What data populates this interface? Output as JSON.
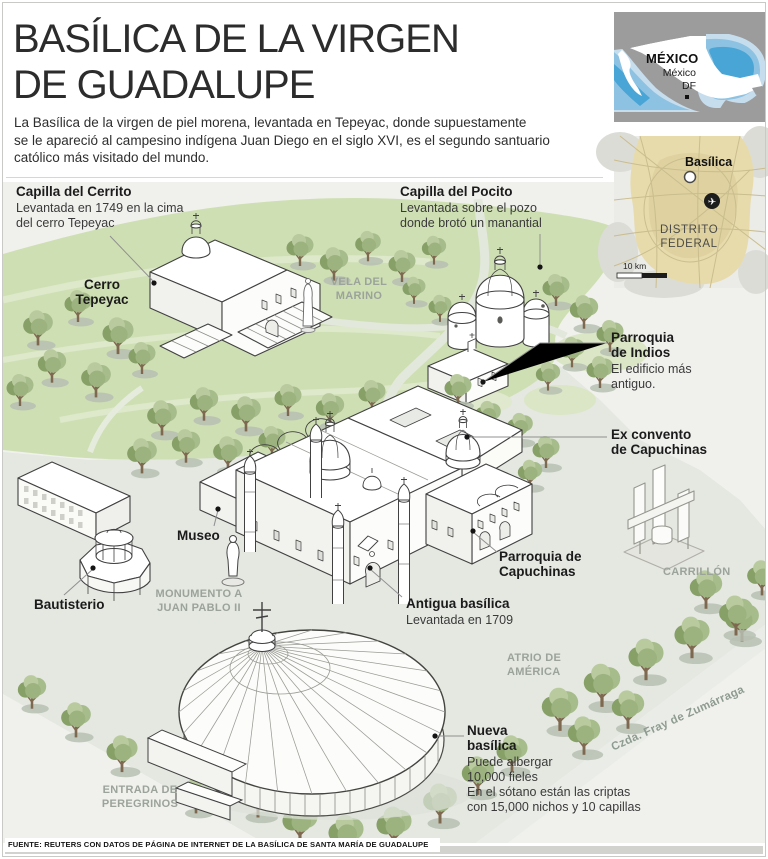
{
  "header": {
    "title": "BASÍLICA DE LA VIRGEN\nDE GUADALUPE",
    "intro": "La Basílica de la virgen de piel morena, levantada en Tepeyac, donde supuestamente\nse le apareció al campesino indígena Juan Diego en el siglo XVI, es el segundo santuario\ncatólico más visitado del mundo."
  },
  "maps": {
    "country": {
      "name": "MÉXICO",
      "city": "México\nDF"
    },
    "city": {
      "poi": "Basílica",
      "region": "DISTRITO\nFEDERAL",
      "scale": "10 km"
    }
  },
  "callouts": {
    "cerrito": {
      "title": "Capilla del Cerrito",
      "desc": "Levantada en 1749 en la cima\ndel cerro Tepeyac"
    },
    "pocito": {
      "title": "Capilla del Pocito",
      "desc": "Levantada sobre el pozo\ndonde brotó un manantial"
    },
    "indios": {
      "title": "Parroquia\nde Indios",
      "desc": "El edificio más\nantiguo."
    },
    "exconvento": {
      "title": "Ex convento\nde Capuchinas"
    },
    "museo": {
      "title": "Museo"
    },
    "bautisterio": {
      "title": "Bautisterio"
    },
    "capuchinas": {
      "title": "Parroquia de\nCapuchinas"
    },
    "antigua": {
      "title": "Antigua basílica",
      "desc": "Levantada en 1709"
    },
    "nueva": {
      "title": "Nueva\nbasílica",
      "desc": "Puede albergar\n10,000 fieles\nEn el sótano están las criptas\ncon 15,000 nichos y 10 capillas"
    }
  },
  "areas": {
    "cerro": "Cerro\nTepeyac",
    "vela": "VELA DEL\nMARINO",
    "monumento": "MONUMENTO A\nJUAN PABLO II",
    "carrillon": "CARRILLÓN",
    "atrio": "ATRIO DE\nAMÉRICA",
    "entrada": "ENTRADA DE\nPEREGRINOS",
    "calzada": "Czda. Fray de Zumárraga"
  },
  "footer": {
    "source": "FUENTE: REUTERS CON DATOS DE PÁGINA DE INTERNET DE LA BASÍLICA DE SANTA MARÍA DE GUADALUPE"
  },
  "colors": {
    "hill_green": "#cfdfb4",
    "plaza_gray": "#e4e8e1",
    "water_blue": "#49a5d5",
    "urban_tan": "#e7dbac",
    "label_gray": "#9ba39a"
  }
}
